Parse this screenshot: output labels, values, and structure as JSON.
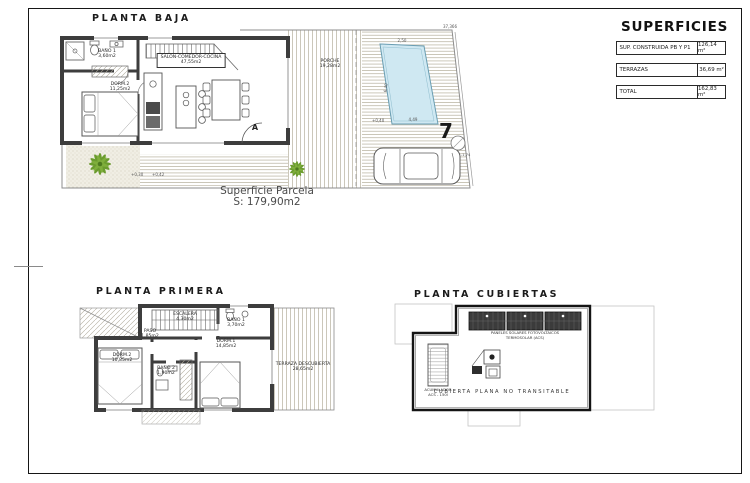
{
  "superficies": {
    "title": "SUPERFICIES",
    "rows": [
      {
        "label": "SUP. CONSTRUIDA PB Y P1",
        "value": "126,14 m²"
      },
      {
        "label": "TERRAZAS",
        "value": "36,69 m²"
      },
      {
        "label": "TOTAL",
        "value": "162,83 m²"
      }
    ]
  },
  "pb": {
    "title": "PLANTA BAJA",
    "rooms": {
      "bano1": {
        "name": "BAÑO 1",
        "area": "3,60m2"
      },
      "dorm2": {
        "name": "DORM.2",
        "area": "11,25m2"
      },
      "salon": {
        "name": "SALON-COMEDOR-COCINA",
        "area": "47,55m2"
      },
      "porche": {
        "name": "PORCHE",
        "area": "19,28m2"
      }
    },
    "levels": {
      "a": "+0,30",
      "b": "+0,42",
      "c": "+0,40"
    },
    "dims": {
      "survey": "37,366",
      "pool_top": "2,50",
      "pool_side": "6,40",
      "pool_bottom": "4,49",
      "corner": "-1,74"
    },
    "section_marker": "A",
    "plot_number": "7",
    "parcel": {
      "line1": "Superficie Parcela",
      "line2": "S: 179,90m2"
    }
  },
  "pp": {
    "title": "PLANTA PRIMERA",
    "rooms": {
      "escalera": {
        "name": "ESCALERA",
        "area": "4,30m2"
      },
      "paso": {
        "name": "PASO",
        "area": "1,85m2"
      },
      "bano1": {
        "name": "BAÑO 1",
        "area": "3,70m2"
      },
      "dorm1": {
        "name": "DORM.1",
        "area": "14,85m2"
      },
      "dorm2": {
        "name": "DORM.2",
        "area": "10,85m2"
      },
      "bano2": {
        "name": "BAÑO 2",
        "area": "1,90m2"
      },
      "terraza": {
        "name": "TERRAZA DESCUBIERTA",
        "area": "28,65m2"
      }
    }
  },
  "pc": {
    "title": "PLANTA CUBIERTAS",
    "labels": {
      "panels1": "PANELES SOLARES FOTOVOLTAICOS",
      "panels2": "TERMOSOLAR (ACS)",
      "acum1": "ACUMULADOR",
      "acum2": "ACS - 150l",
      "roof": "CUBIERTA PLANA NO TRANSITABLE"
    }
  }
}
